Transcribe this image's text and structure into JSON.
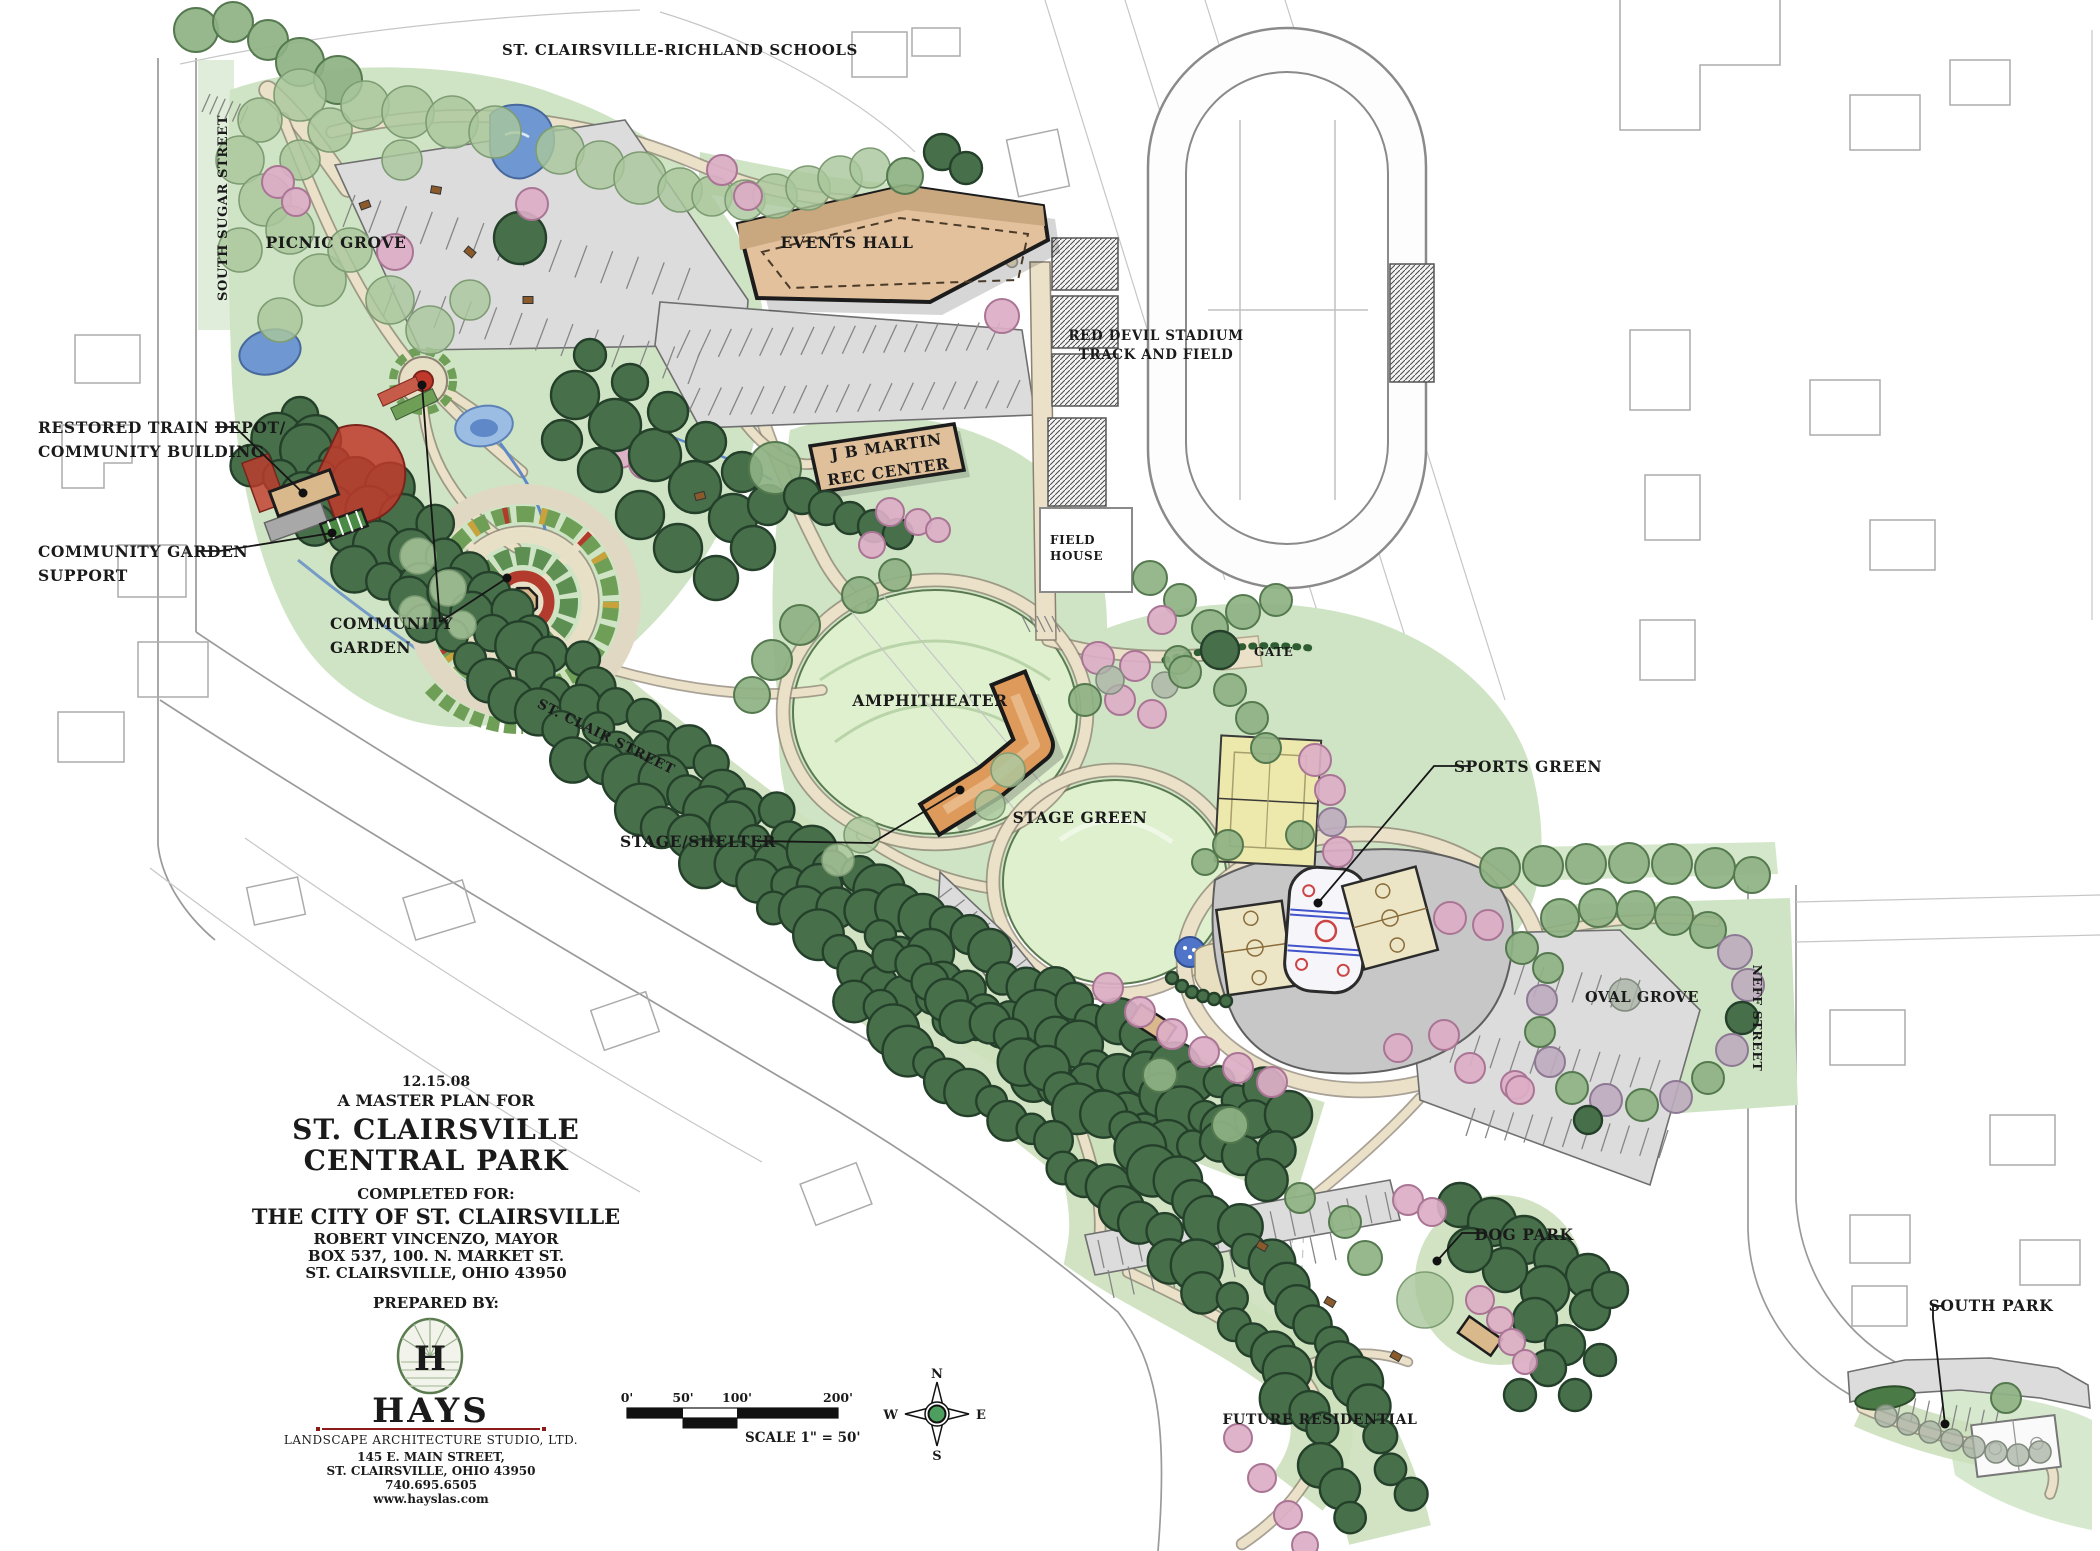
{
  "map_labels": {
    "schools": "ST. CLAIRSVILLE-RICHLAND SCHOOLS",
    "south_sugar_street": "SOUTH SUGAR STREET",
    "st_clair_street": "ST. CLAIR STREET",
    "neff_street": "NEFF STREET",
    "picnic_grove": "PICNIC GROVE",
    "events_hall": "EVENTS HALL",
    "red_devil_stadium_line1": "RED DEVIL STADIUM",
    "red_devil_stadium_line2": "TRACK AND FIELD",
    "jb_martin_line1": "J B MARTIN",
    "jb_martin_line2": "REC CENTER",
    "field_house_line1": "FIELD",
    "field_house_line2": "HOUSE",
    "gate": "GATE",
    "amphitheater": "AMPHITHEATER",
    "stage_green": "STAGE GREEN",
    "oval_grove": "OVAL GROVE",
    "future_residential": "FUTURE RESIDENTIAL"
  },
  "callouts": {
    "restored_train_depot_line1": "RESTORED TRAIN DEPOT/",
    "restored_train_depot_line2": "COMMUNITY BUILDING",
    "community_garden_support_line1": "COMMUNITY GARDEN",
    "community_garden_support_line2": "SUPPORT",
    "community_garden_line1": "COMMUNITY",
    "community_garden_line2": "GARDEN",
    "stage_shelter": "STAGE/SHELTER",
    "sports_green": "SPORTS GREEN",
    "dog_park": "DOG PARK",
    "south_park": "SOUTH PARK"
  },
  "title_block": {
    "date": "12.15.08",
    "subtitle": "A MASTER PLAN FOR",
    "title_line1": "ST. CLAIRSVILLE",
    "title_line2": "CENTRAL PARK",
    "completed_for": "COMPLETED FOR:",
    "client": "THE CITY OF ST. CLAIRSVILLE",
    "client_line2": "ROBERT VINCENZO, MAYOR",
    "client_line3": "BOX 537, 100. N. MARKET ST.",
    "client_line4": "ST. CLAIRSVILLE, OHIO 43950",
    "prepared_by": "PREPARED BY:"
  },
  "logo": {
    "monogram": "H",
    "name": "HAYS",
    "studio": "LANDSCAPE ARCHITECTURE STUDIO, LTD.",
    "address_line1": "145 E. MAIN STREET,",
    "address_line2": "ST. CLAIRSVILLE, OHIO 43950",
    "phone": "740.695.6505",
    "website": "www.hayslas.com"
  },
  "scale_bar": {
    "tick_0": "0'",
    "tick_50": "50'",
    "tick_100": "100'",
    "tick_200": "200'",
    "caption": "SCALE 1\" = 50'"
  },
  "compass": {
    "north": "N",
    "east": "E",
    "south": "S",
    "west": "W"
  },
  "colors": {
    "park_green": "#cfe4c4",
    "lawn_green": "#dff0cf",
    "dark_tree": "#47704a",
    "pink_tree": "#dcaec6",
    "building_tan": "#e3c19c",
    "shelter_orange": "#dd9a5b",
    "water_blue": "#6f98d2",
    "parking_gray": "#dcdcdc",
    "accent_red": "#b23b2e",
    "logo_green": "#2f4f2a",
    "rule_red": "#8b1a1a"
  }
}
